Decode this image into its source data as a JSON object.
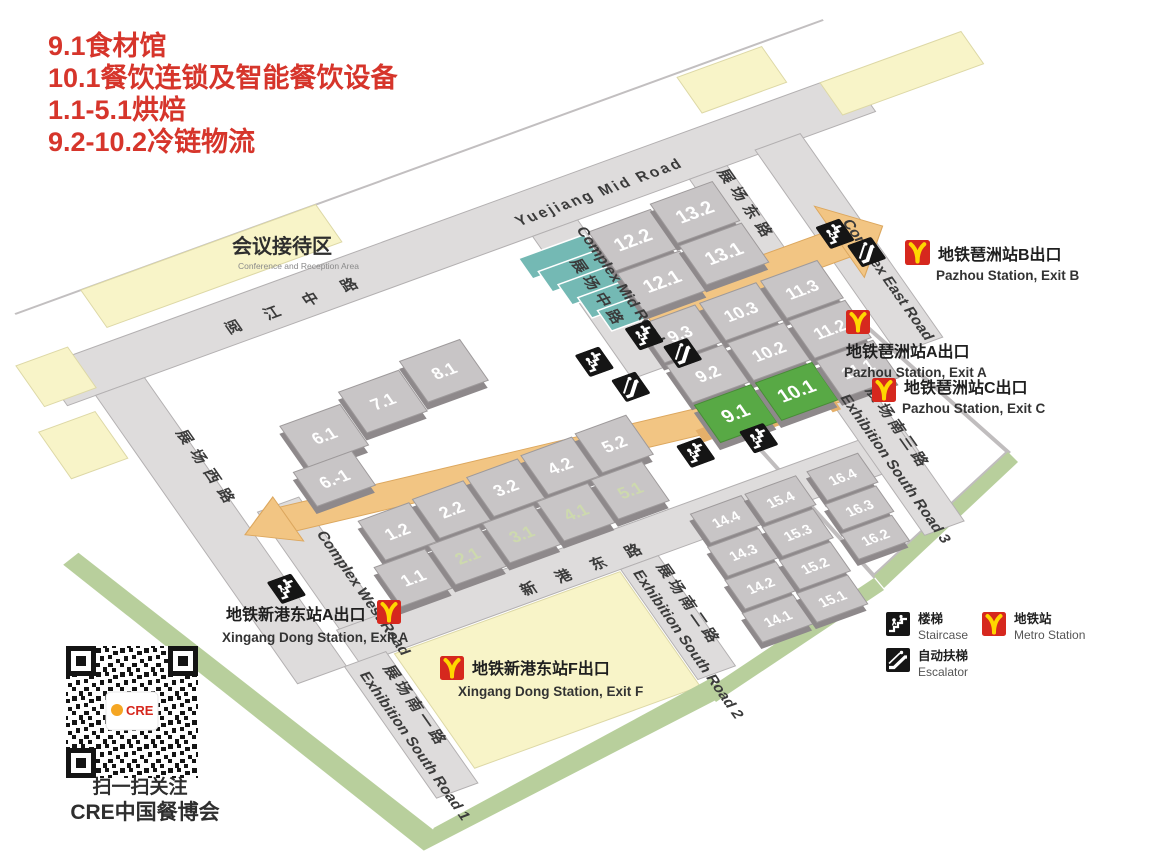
{
  "title": {
    "lines": [
      "9.1食材馆",
      "10.1餐饮连锁及智能餐饮设备",
      "1.1-5.1烘焙",
      "9.2-10.2冷链物流"
    ],
    "color": "#d6352b"
  },
  "roads": {
    "yuejiang_en": "Yuejiang Mid Road",
    "yuejiang_cn": "阅江中路",
    "mid_en": "Complex Mid Road",
    "mid_cn": "展场中路",
    "east_en": "Complex East Road",
    "east_cn": "展场东路",
    "west_cn": "展场西路",
    "cwr_en": "Complex West Road",
    "xingang_cn": "新港东路",
    "esr1_cn": "展场南一路",
    "esr1_en": "Exhibition South Road 1",
    "esr2_cn": "展场南二路",
    "esr2_en": "Exhibition South Road 2",
    "esr3_cn": "展场南三路",
    "esr3_en": "Exhibition South Road 3"
  },
  "areas": {
    "conference_cn": "会议接待区",
    "conference_en": "Conference and Reception Area"
  },
  "halls": {
    "h1_1": "1.1",
    "h1_2": "1.2",
    "h2_1": "2.1",
    "h2_2": "2.2",
    "h3_1": "3.1",
    "h3_2": "3.2",
    "h4_1": "4.1",
    "h4_2": "4.2",
    "h5_1": "5.1",
    "h5_2": "5.2",
    "h6_1": "6.1",
    "h6_b1": "6.-1",
    "h7_1": "7.1",
    "h8_1": "8.1",
    "h9_1": "9.1",
    "h9_2": "9.2",
    "h9_3": "9.3",
    "h10_1": "10.1",
    "h10_2": "10.2",
    "h10_3": "10.3",
    "h11_1": "11.1",
    "h11_2": "11.2",
    "h11_3": "11.3",
    "h12_1": "12.1",
    "h12_2": "12.2",
    "h13_1": "13.1",
    "h13_2": "13.2",
    "h14_1": "14.1",
    "h14_2": "14.2",
    "h14_3": "14.3",
    "h14_4": "14.4",
    "h15_1": "15.1",
    "h15_2": "15.2",
    "h15_3": "15.3",
    "h15_4": "15.4",
    "h16_2": "16.2",
    "h16_3": "16.3",
    "h16_4": "16.4"
  },
  "metro": {
    "pz_b_cn": "地铁琶洲站B出口",
    "pz_b_en": "Pazhou Station, Exit B",
    "pz_a_cn": "地铁琶洲站A出口",
    "pz_a_en": "Pazhou Station, Exit A",
    "pz_c_cn": "地铁琶洲站C出口",
    "pz_c_en": "Pazhou Station, Exit C",
    "xg_a_cn": "地铁新港东站A出口",
    "xg_a_en": "Xingang Dong Station, Exit A",
    "xg_f_cn": "地铁新港东站F出口",
    "xg_f_en": "Xingang Dong Station, Exit F"
  },
  "legend": {
    "stair_cn": "楼梯",
    "stair_en": "Staircase",
    "metro_cn": "地铁站",
    "metro_en": "Metro Station",
    "esc_cn": "自动扶梯",
    "esc_en": "Escalator"
  },
  "qr": {
    "cap1": "扫一扫关注",
    "cap2": "CRE中国餐博会",
    "logo": "CRE"
  },
  "colors": {
    "hall_green": "#58a945",
    "hall_gray": "#c8c5c6",
    "walkway_orange": "#f2c583",
    "metro_red": "#d6281e",
    "metro_yellow": "#ffd700",
    "title_red": "#d6352b"
  }
}
